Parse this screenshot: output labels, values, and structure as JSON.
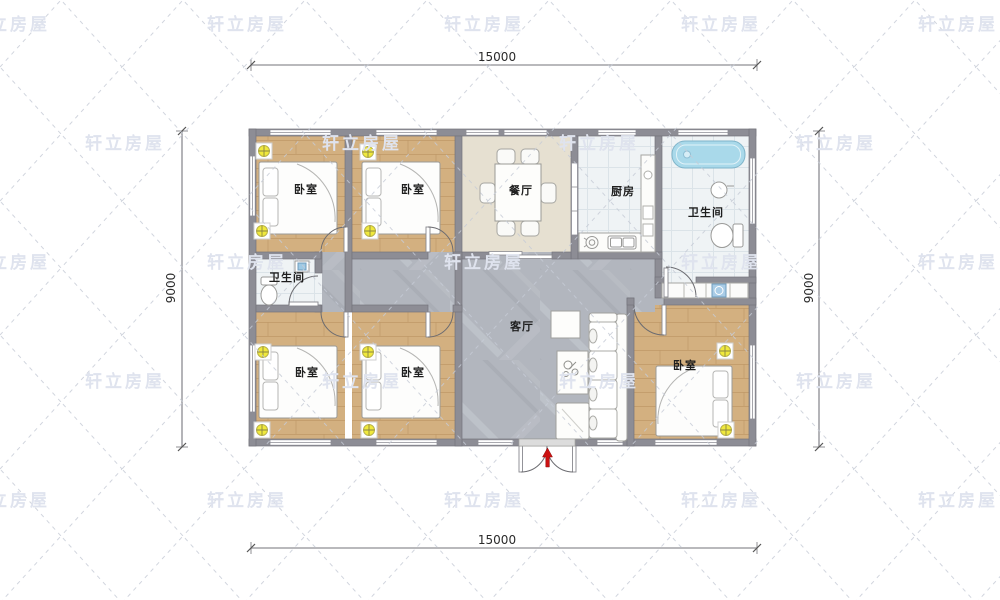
{
  "brand_watermark": "轩立房屋",
  "dimensions": {
    "top": "15000",
    "bottom": "15000",
    "left": "9000",
    "right": "9000"
  },
  "rooms": {
    "bedroom_top_left": "卧室",
    "bedroom_top_mid": "卧室",
    "dining": "餐厅",
    "kitchen": "厨房",
    "bath_top_right": "卫生间",
    "bath_mid_left": "卫生间",
    "bedroom_bottom_left": "卧室",
    "bedroom_bottom_mid": "卧室",
    "bedroom_bottom_right": "卧室",
    "living": "客厅"
  },
  "colors": {
    "watermark": "#dfe3ee",
    "lamp_marker": "#f0e93c",
    "bathtub": "#a9d9ea",
    "washer": "#a9cce6",
    "entrance_arrow": "#cc1111",
    "wall": "#8d8d95",
    "wood_floor": "#d3b080",
    "marble_floor": "#b2b6be",
    "dining_floor": "#e6e0d1",
    "tile_floor": "#eff3f5"
  }
}
